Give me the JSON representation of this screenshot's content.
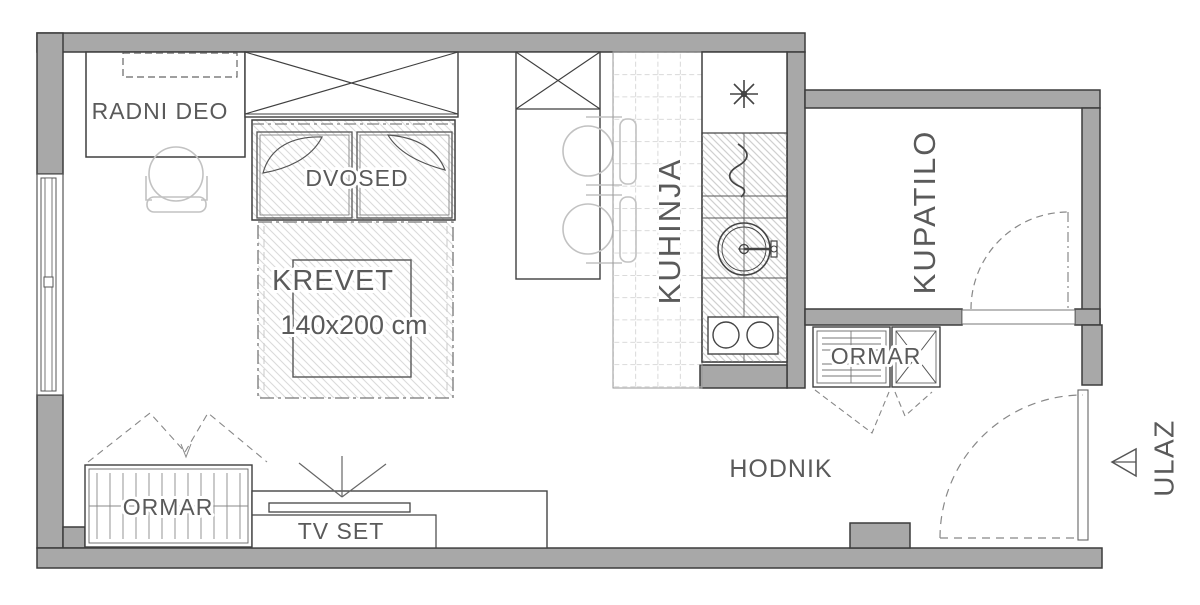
{
  "plan": {
    "rooms": {
      "work_area_label": "RADNI DEO",
      "sofa_label": "DVOSED",
      "bed_label": "KREVET",
      "bed_dimensions": "140x200 cm",
      "kitchen_label": "KUHINJA",
      "bathroom_label": "KUPATILO",
      "hallway_label": "HODNIK",
      "entrance_label": "ULAZ",
      "tv_label": "TV SET",
      "wardrobe_hall_label": "ORMAR",
      "wardrobe_living_label": "ORMAR"
    },
    "colors": {
      "wall_fill": "#a8a8a8",
      "wall_outline": "#3c3c3c",
      "furniture_line": "#555555",
      "light_line": "#c2c2c2",
      "hatch_line": "#d6d6d6",
      "tile_line": "#c4c4c4",
      "text": "#5a5a5a",
      "background": "#ffffff"
    }
  }
}
